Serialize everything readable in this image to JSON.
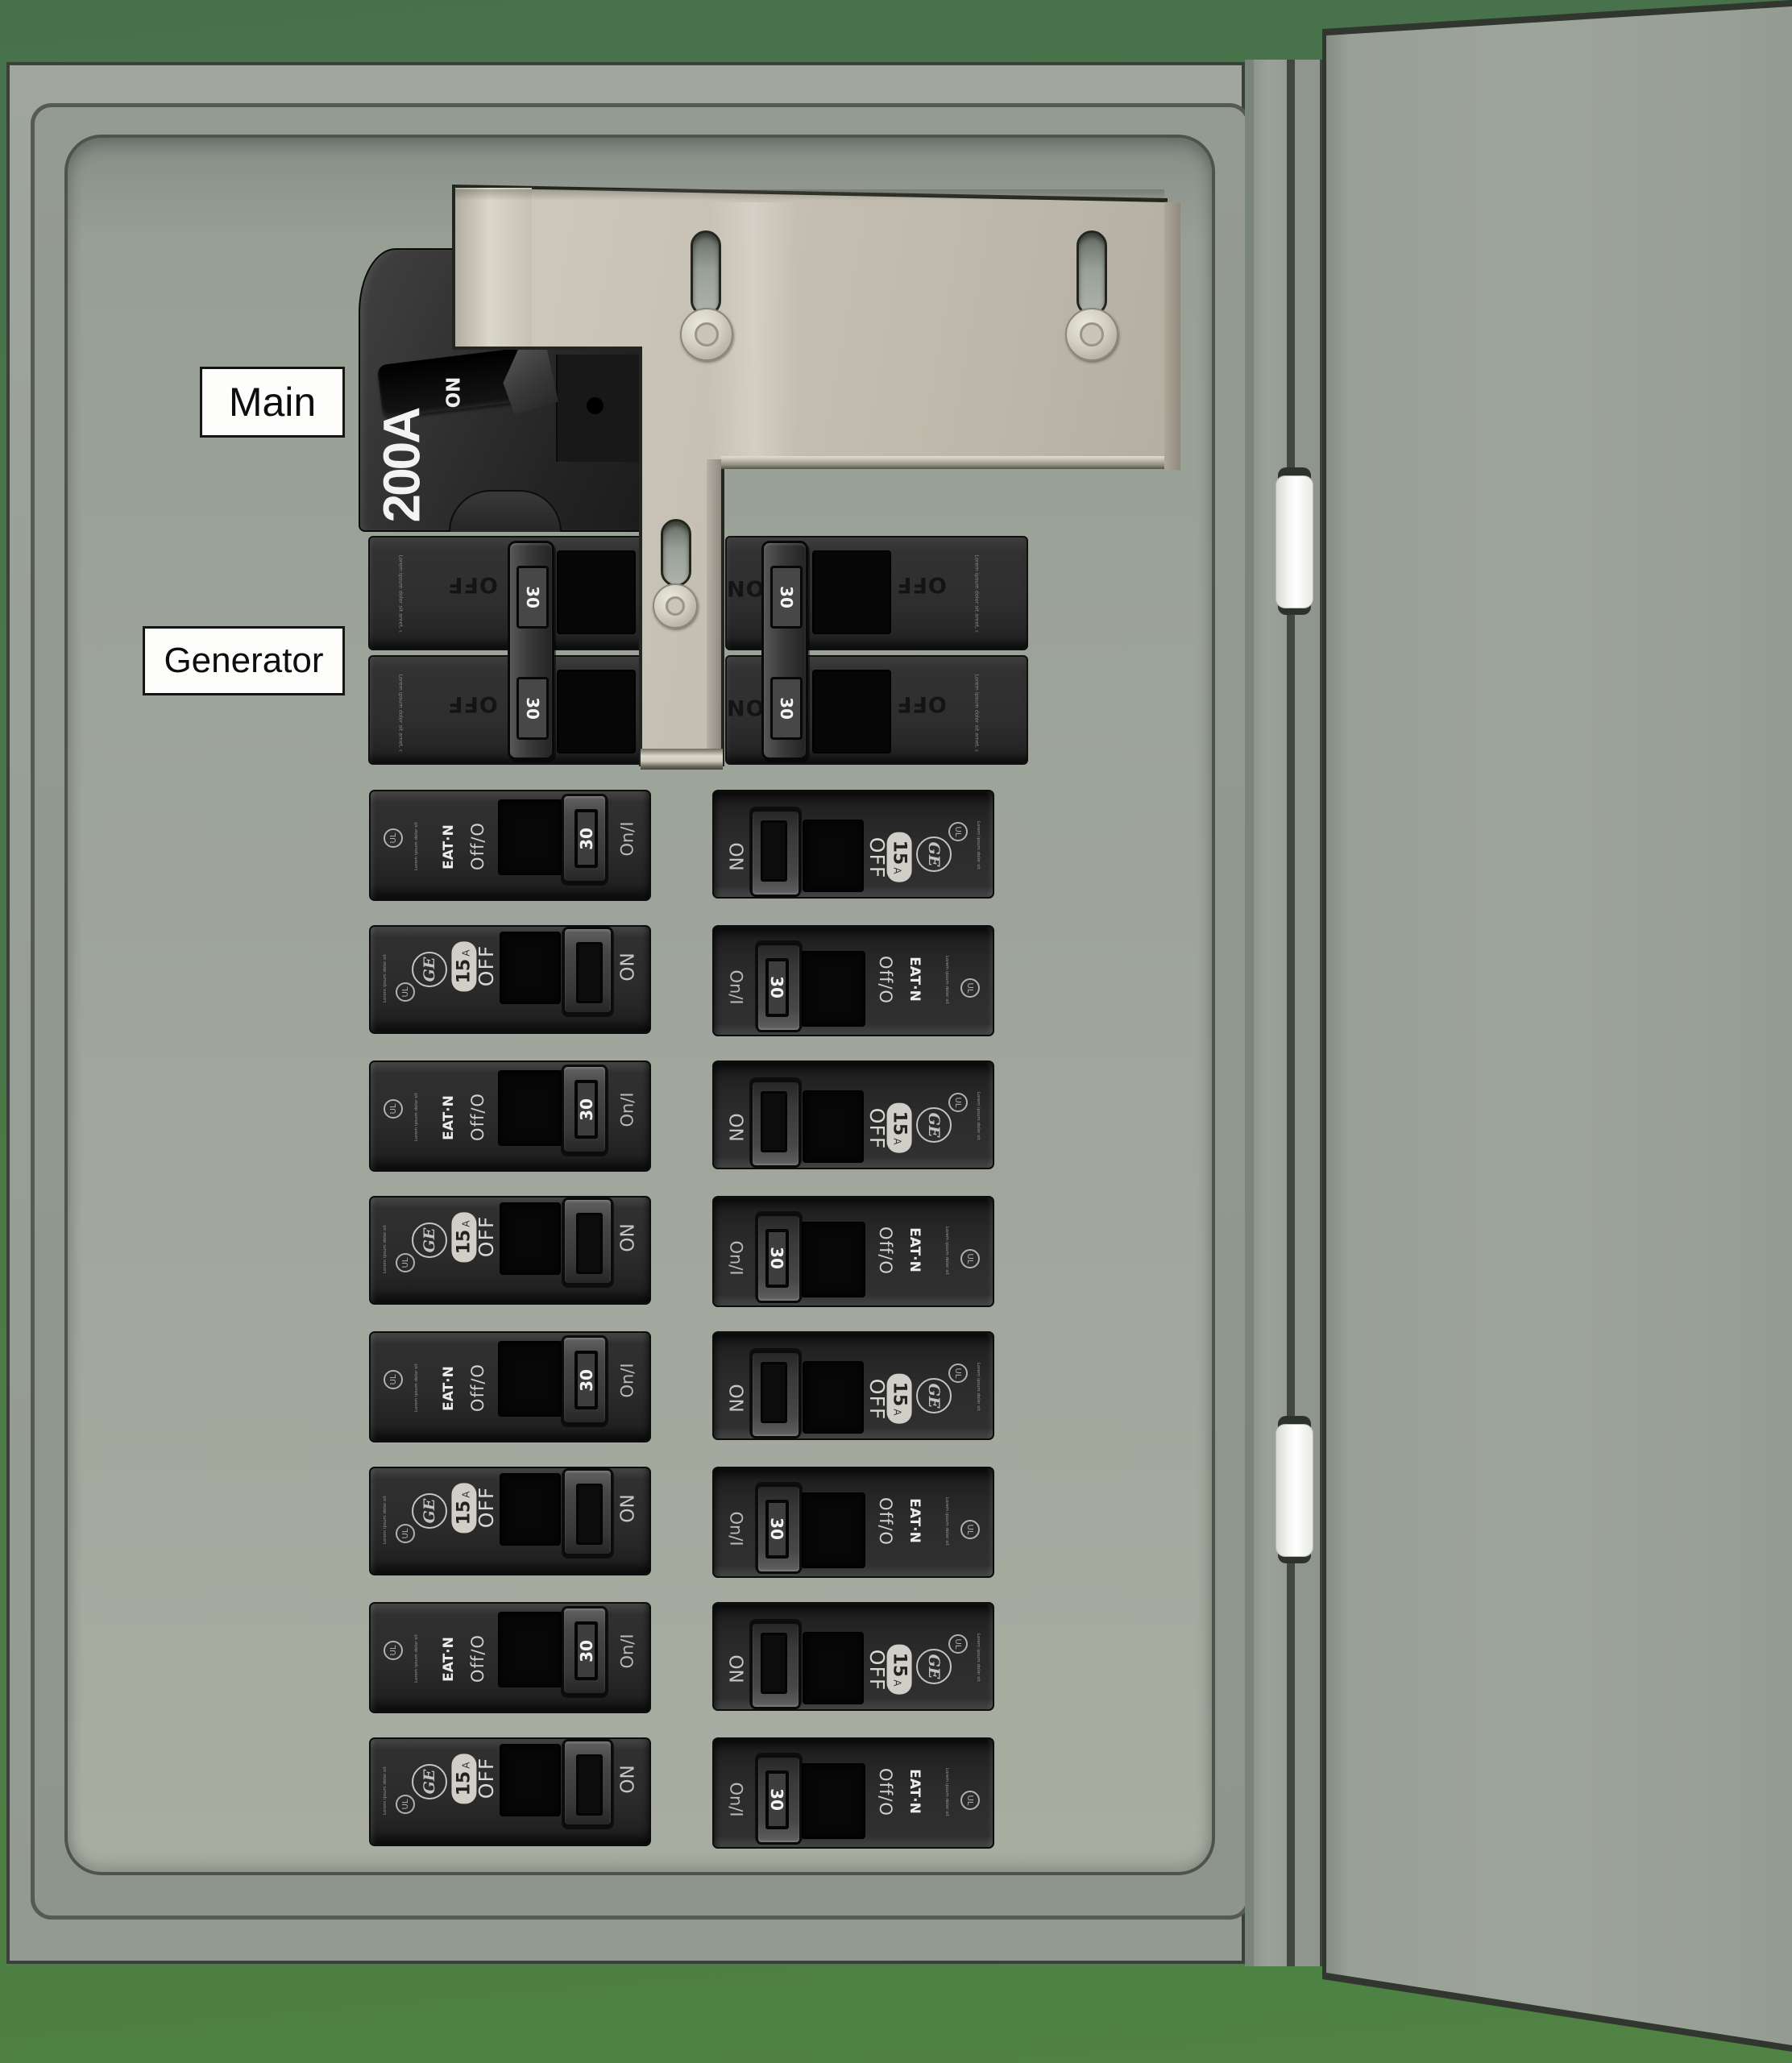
{
  "labels": {
    "main": "Main",
    "generator": "Generator"
  },
  "main_breaker": {
    "rating": "200A",
    "handle_position": "ON"
  },
  "generator_pair": {
    "handle_amp": "30",
    "off_label": "OFF",
    "on_label": "ON"
  },
  "breaker_types": {
    "eaton": {
      "off_label": "Off/O",
      "on_label": "On/I",
      "handle_amp": "30"
    },
    "ge": {
      "off_label": "OFF",
      "on_label": "ON",
      "amp": "15",
      "amp_unit": "A"
    }
  },
  "brands": {
    "eaton": "EAT·N",
    "ge": "GE"
  },
  "ul_mark": "UL",
  "fine_print": "Lorem ipsum dolor sit amet, consectetur adipiscing elit, sed do eiusmod tempor incididunt ut labore et dolore magna aliqua. Ut enim ad minim veniam, quis nostrud exercitation ullamco laboris nisi ut aliquip ex ea commodo consequat.",
  "left_column": [
    "eaton",
    "ge",
    "eaton",
    "ge",
    "eaton",
    "ge",
    "eaton",
    "ge"
  ],
  "right_column": [
    "ge",
    "eaton",
    "ge",
    "eaton",
    "ge",
    "eaton",
    "ge",
    "eaton"
  ],
  "colors": {
    "background_green": "#4b7a47",
    "cabinet_gray": "#9aa199",
    "panel_pan": "#9da49b",
    "interlock_plate": "#c3beb1",
    "breaker_body": "#2d2d2d",
    "label_background": "#fdfdfc",
    "label_text": "#0d0d0d",
    "hinge_white": "#f2f3f0"
  }
}
